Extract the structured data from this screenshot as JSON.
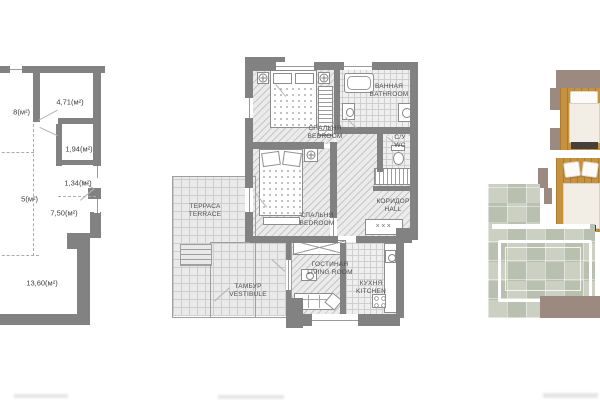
{
  "panels": {
    "left_plan": {
      "areas": [
        {
          "label": "8(м²)"
        },
        {
          "label": "4,71(м²)"
        },
        {
          "label": "1,94(м²)"
        },
        {
          "label": "1,34(м²)"
        },
        {
          "label": "5(м²)"
        },
        {
          "label": "7,50(м²)"
        },
        {
          "label": "13,60(м²)"
        }
      ]
    },
    "center_plan": {
      "rooms": [
        {
          "ru": "СПАЛЬНЯ",
          "en": "BEDROOM"
        },
        {
          "ru": "ВАННАЯ",
          "en": "BATHROOM"
        },
        {
          "ru": "С/У",
          "en": "WC"
        },
        {
          "ru": "СПАЛЬНЯ",
          "en": "BEDROOM"
        },
        {
          "ru": "КОРИДОР",
          "en": "HALL"
        },
        {
          "ru": "ТЕРРАСА",
          "en": "TERRACE"
        },
        {
          "ru": "ТАМБУР",
          "en": "VESTIBULE"
        },
        {
          "ru": "ГОСТИНАЯ",
          "en": "LIVING ROOM"
        },
        {
          "ru": "КУХНЯ",
          "en": "KITCHEN"
        }
      ],
      "wardrobe_marks": "×××"
    }
  },
  "colors": {
    "plan_wall_gray": "#828282",
    "plan_line_gray": "#9a9a9a",
    "plan_text": "#3d3d3d",
    "hatch_fill": "#ebebeb",
    "render_wall_taupe": "#9c8a80",
    "render_wood": "#c7923f",
    "render_stone": "#c4c9bb",
    "render_bedding": "#f2eee5"
  }
}
